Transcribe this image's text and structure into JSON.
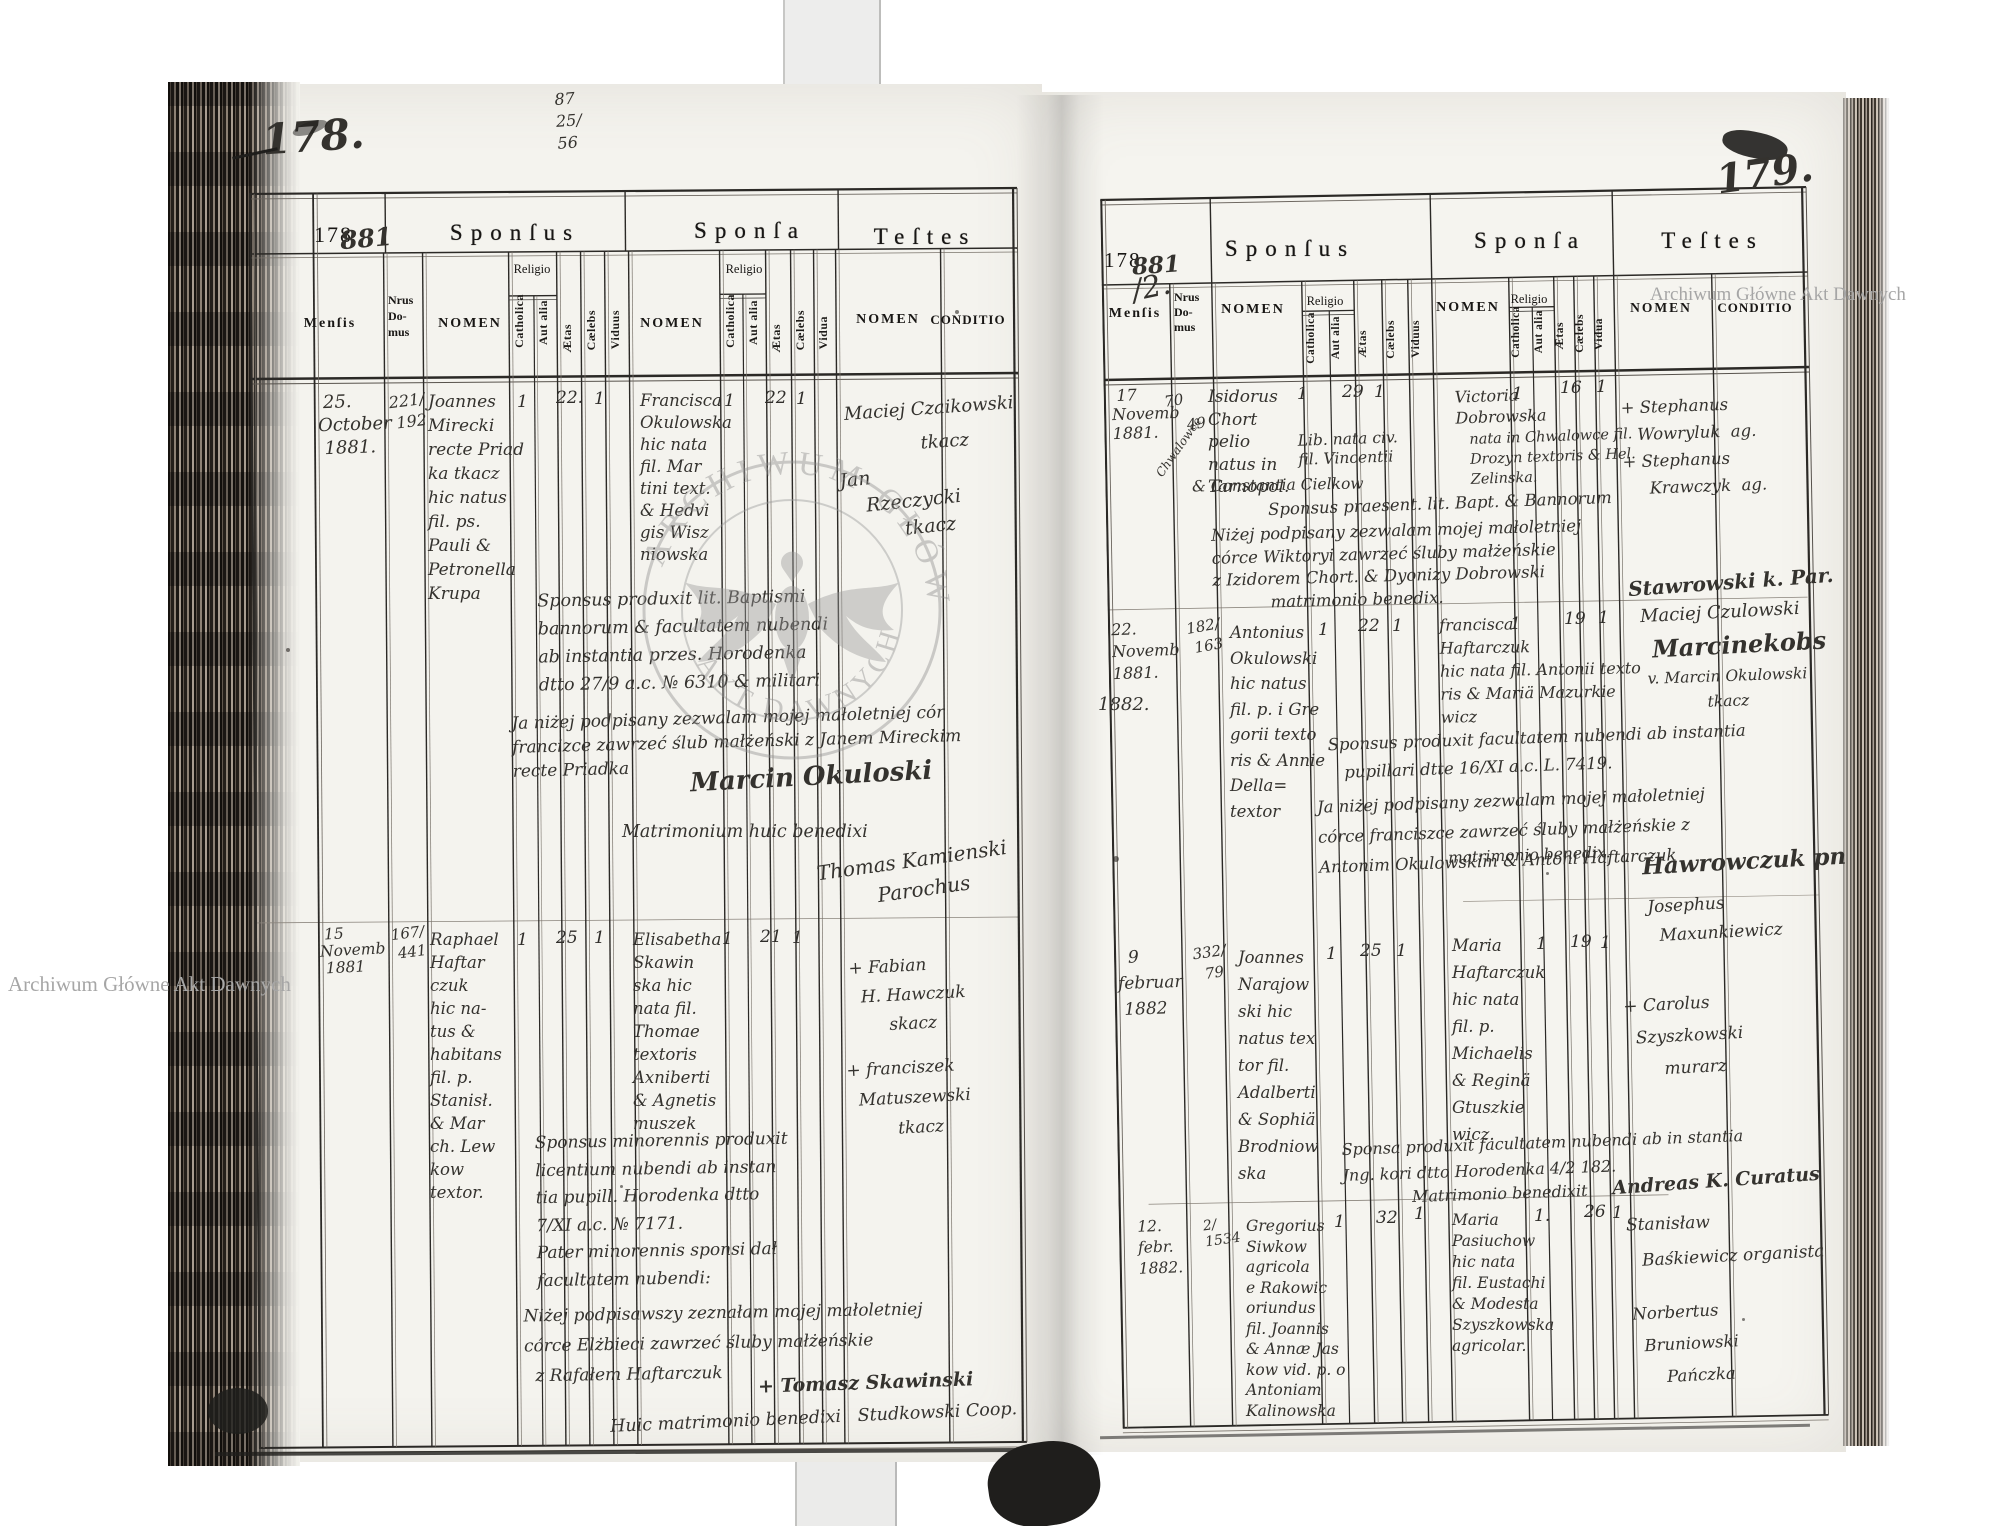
{
  "hdr": {
    "year": "178",
    "year_hand_left": "881",
    "year_hand_right": "881",
    "year_hand_right2": "/2.",
    "sponsus": "Sponſus",
    "sponsa": "Sponſa",
    "testes": "Teſtes",
    "mensis": "Menſis",
    "nrus": [
      "Nrus",
      "Do-",
      "mus"
    ],
    "nomen": "NOMEN",
    "religio": "Religio",
    "catholica": "Catholica",
    "aut_alia": "Aut alia",
    "aetas": "Ætas",
    "caelebs": "Cælebs",
    "viduus": "Viduus",
    "vidua": "Vidua",
    "conditio": "CONDITIO"
  },
  "stamp": {
    "arc_top": "ARCHIWUM GŁÓWNE",
    "arc_bottom": "AKT DAWNYCH"
  },
  "watermark": {
    "top_right": "Archiwum Główne Akt Dawnych",
    "bottom_left": "Archiwum Główne Akt Dawnych"
  },
  "left": {
    "folio": "178.",
    "fraction": [
      "87",
      "25/",
      "56"
    ],
    "e1": {
      "date": [
        " 25.",
        "October",
        " 1881."
      ],
      "house": [
        "221/",
        " 192"
      ],
      "groom": [
        "Joannes",
        "Mirecki",
        "recte Priad",
        "ka tkacz",
        "hic natus",
        "fil. ps.",
        "Pauli &",
        "Petronella",
        "Krupa"
      ],
      "g_cath": "1",
      "g_aetas": "22.",
      "g_cael": "1",
      "bride": [
        "Francisca",
        "Okulowska",
        "hic nata",
        "fil. Mar",
        "tini text.",
        "& Hedvi",
        "gis Wisz",
        "niowska"
      ],
      "b_cath": "1",
      "b_aetas": "22",
      "b_cael": "1",
      "wit": [
        "Maciej Czaikowski",
        "             tkacz"
      ],
      "wit2": [
        "Jan",
        "    Rzeczycki",
        "          tkacz"
      ],
      "notes": [
        "Sponsus produxit lit. Baptismi",
        "bannorum & facultatem nubendi",
        "ab instantia przes. Horodenka",
        "dtto 27/9 a.c. № 6310 & militari"
      ],
      "consent": [
        "Ja niżej podpisany zezwalam mojej małoletniej cór",
        "francizce zawrzeć ślub małżeński z Janem Mireckim",
        "recte Priadka"
      ],
      "sig": "Marcin Okuloski",
      "bened": "Matrimonium huic benedixi",
      "bened2": [
        "Thomas Kamienski",
        "         Parochus"
      ]
    },
    "e2": {
      "date": [
        " 15",
        "Novemb",
        " 1881"
      ],
      "house": [
        "167/",
        " 441"
      ],
      "groom": [
        "Raphael",
        "Haftar",
        "czuk",
        "hic na-",
        "tus &",
        "habitans",
        "fil. p.",
        "Stanisł.",
        "& Mar",
        "ch. Lew",
        "kow",
        "textor."
      ],
      "g_cath": "1",
      "g_aetas": "25",
      "g_cael": "1",
      "bride": [
        "Elisabetha",
        "Skawin",
        "ska hic",
        "nata fil.",
        "Thomae",
        "textoris",
        "Axniberti",
        "& Agnetis",
        "muszek"
      ],
      "b_cath": "1",
      "b_aetas": "21",
      "b_cael": "1",
      "wit": [
        "+ Fabian",
        "  H. Hawczuk",
        "       skacz"
      ],
      "wit2": [
        "+ franciszek",
        "  Matuszewski",
        "         tkacz"
      ],
      "notes": [
        "Sponsus minorennis produxit",
        "licentium nubendi ab instan",
        "tia pupill. Horodenka dtto",
        "7/XI a.c. № 7171.",
        "Pater minorennis sponsi dał",
        "facultatem nubendi:"
      ],
      "consent": [
        "Niżej podpisawszy zeznałam mojej małoletniej",
        "córce Elżbieci zawrzeć śluby małżeńskie",
        "  z Rafałem Haftarczuk"
      ],
      "sig": "+ Tomasz Skawinski"
    },
    "bottom_note": "Huic matrimonio benedixi   Studkowski Coop."
  },
  "right": {
    "folio": "179.",
    "e1": {
      "date": [
        " 17",
        "Novemb",
        "1881."
      ],
      "house": [
        "70",
        "    49"
      ],
      "house_rot": "Chwalowce",
      "groom": [
        "Isidorus",
        "Chort",
        "pelio",
        "natus in",
        "Tarnopol."
      ],
      "groom_x": [
        "Lib. nata civ.",
        "fil. Vincentii"
      ],
      "groom_x2": "& Constantia Cielkow",
      "g_cath": "1",
      "g_aetas": "29",
      "g_cael": "1",
      "bride": [
        "Victoria",
        "Dobrowska"
      ],
      "bride_x": [
        "nata in Chwalowce fil.",
        "Drozyn textoris & Hel.",
        "Zelinska."
      ],
      "b_cath": "1",
      "b_aetas": "16",
      "b_cael": "1",
      "wit": [
        "+ Stephanus",
        "   Wowryluk  ag.",
        "+ Stephanus",
        "     Krawczyk  ag."
      ],
      "notes": [
        "Sponsus praesent. lit. Bapt. & Bannorum"
      ],
      "consent": [
        "Niżej podpisany zezwalam mojej małoletniej",
        "córce Wiktoryi zawrzeć śluby małżeńskie",
        "z Izidorem Chort. & Dyonizy Dobrowski",
        "           matrimonio benedix."
      ],
      "sig": "Stawrowski k. Par."
    },
    "e2": {
      "date": [
        "22.",
        "Novemb",
        "1881."
      ],
      "house": [
        "182/",
        " 163"
      ],
      "groom": [
        "Antonius",
        "Okulowski",
        "hic natus",
        "fil. p. i Gre",
        "gorii texto",
        "ris & Annie",
        "Della=",
        "textor"
      ],
      "g_cath": "1",
      "g_aetas": "22",
      "g_cael": "1",
      "bride": [
        "francisca",
        "Haftarczuk",
        "hic nata fil. Antonii texto",
        "ris & Mariä Mazurkie",
        "wicz"
      ],
      "b_cath": "1",
      "b_aetas": "19",
      "b_cael": "1",
      "wit": "Maciej Czulowski",
      "wit_bold": "Marcinekobs",
      "wit2": [
        "v. Marcin Okulowski",
        "            tkacz"
      ],
      "notes": [
        "Sponsus produxit facultatem nubendi ab instantia",
        "   pupillari dtte 16/XI a.c. L. 7419."
      ],
      "consent": [
        "Ja niżej podpisany zezwalam mojej małoletniej",
        "córce franciszce zawrzeć śluby małżeńskie z",
        "Antonim Okulowskim & Antoni Haftarczuk"
      ],
      "bened": "matrimonio benedix.",
      "sig": "Hawrowczuk pn",
      "year_divider": "1882."
    },
    "e3": {
      "date": [
        "  9",
        "februar",
        " 1882"
      ],
      "house": [
        "332/",
        "  79"
      ],
      "groom": [
        "Joannes",
        "Narajow",
        "ski hic",
        "natus tex",
        "tor fil.",
        "Adalberti",
        "& Sophiä",
        "Brodniow",
        "ska"
      ],
      "g_cath": "1",
      "g_aetas": "25",
      "g_cael": "1",
      "bride": [
        "Maria",
        "Haftarczuk",
        "hic nata",
        "fil. p.",
        "Michaelis",
        "& Reginä",
        "Gtuszkie",
        "wicz."
      ],
      "b_cath": "1",
      "b_aetas": "19",
      "b_cael": "1",
      "wit": [
        "Josephus",
        "  Maxunkiewicz"
      ],
      "wit2": [
        "+ Carolus",
        "  Szyszkowski",
        "       murarz"
      ],
      "notes": [
        "Sponsa produxit facultatem nubendi ab in stantia",
        "Jng. kori dtto Horodenka 4/2 182."
      ],
      "bened": "Matrimonio benedixit",
      "sig": "Andreas K. Curatus"
    },
    "e4": {
      "date": [
        "12.",
        "febr.",
        "1882."
      ],
      "house": [
        "2/",
        "1534"
      ],
      "groom": [
        "Gregorius",
        "Siwkow",
        "agricola",
        "e Rakowic",
        "oriundus",
        "fil. Joannis",
        "& Annæ Jas",
        "kow vid. p. o",
        "Antoniam",
        "Kalinowska"
      ],
      "g_cath": "1",
      "g_aetas": "32",
      "g_vid": "1",
      "bride": [
        "Maria",
        "Pasiuchow",
        "hic nata",
        "fil. Eustachi",
        "& Modesta",
        "Szyszkowska",
        "agricolar."
      ],
      "b_cath": "1.",
      "b_aetas": "26",
      "b_cael": "1",
      "wit": "Stanisław",
      "wit_wide": "Baśkiewicz organista",
      "wit2": [
        "Norbertus",
        "  Bruniowski",
        "      Pańczka"
      ]
    }
  }
}
